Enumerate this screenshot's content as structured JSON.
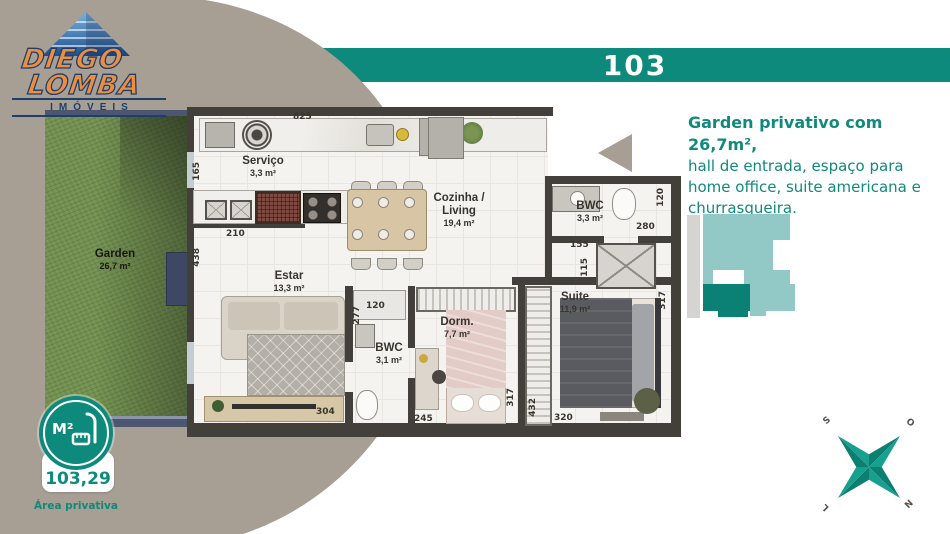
{
  "brand": {
    "line1": "DIEGO",
    "line2": "LOMBA",
    "tagline": "IMÓVEIS"
  },
  "unit_banner": {
    "number": "103"
  },
  "description": {
    "headline": "Garden privativo com 26,7m²,",
    "line2": "hall de entrada, espaço para",
    "line3": "home office, suite americana e",
    "line4": "churrasqueira."
  },
  "area_badge": {
    "icon_label": "M²",
    "value": "103,29",
    "caption": "Área privativa"
  },
  "compass": {
    "south": "S",
    "west": "O",
    "east": "L",
    "north": "N"
  },
  "floor_plan": {
    "rooms": [
      {
        "name": "Serviço",
        "area": "3,3 m²"
      },
      {
        "name": "Cozinha / Living",
        "area": "19,4 m²"
      },
      {
        "name": "BWC",
        "area": "3,3 m²"
      },
      {
        "name": "Estar",
        "area": "13,3 m²"
      },
      {
        "name": "BWC",
        "area": "3,1 m²"
      },
      {
        "name": "Dorm.",
        "area": "7,7 m²"
      },
      {
        "name": "Suite",
        "area": "11,9 m²"
      },
      {
        "name": "Garden",
        "area": "26,7 m²"
      }
    ],
    "dims": {
      "counter_top": "825",
      "servico_left": "165",
      "kitchen_left": "210",
      "estar_left": "438",
      "estar_bottom": "304",
      "estar_right": "277",
      "bwc2_top": "120",
      "dorm_bottom": "245",
      "dorm_right": "317",
      "closet_right": "432",
      "suite_bottom": "320",
      "suite_right": "317",
      "shaft_top": "155",
      "shaft_left": "115",
      "bwc1_bottom": "280",
      "bwc1_right": "120"
    }
  },
  "colors": {
    "teal": "#0e8a7d",
    "taupe": "#a79e94",
    "keyplan_light": "#92c8c6",
    "keyplan_highlight": "#0b8176",
    "logo_orange": "#ee8e3c",
    "logo_navy": "#1c3f6e"
  }
}
